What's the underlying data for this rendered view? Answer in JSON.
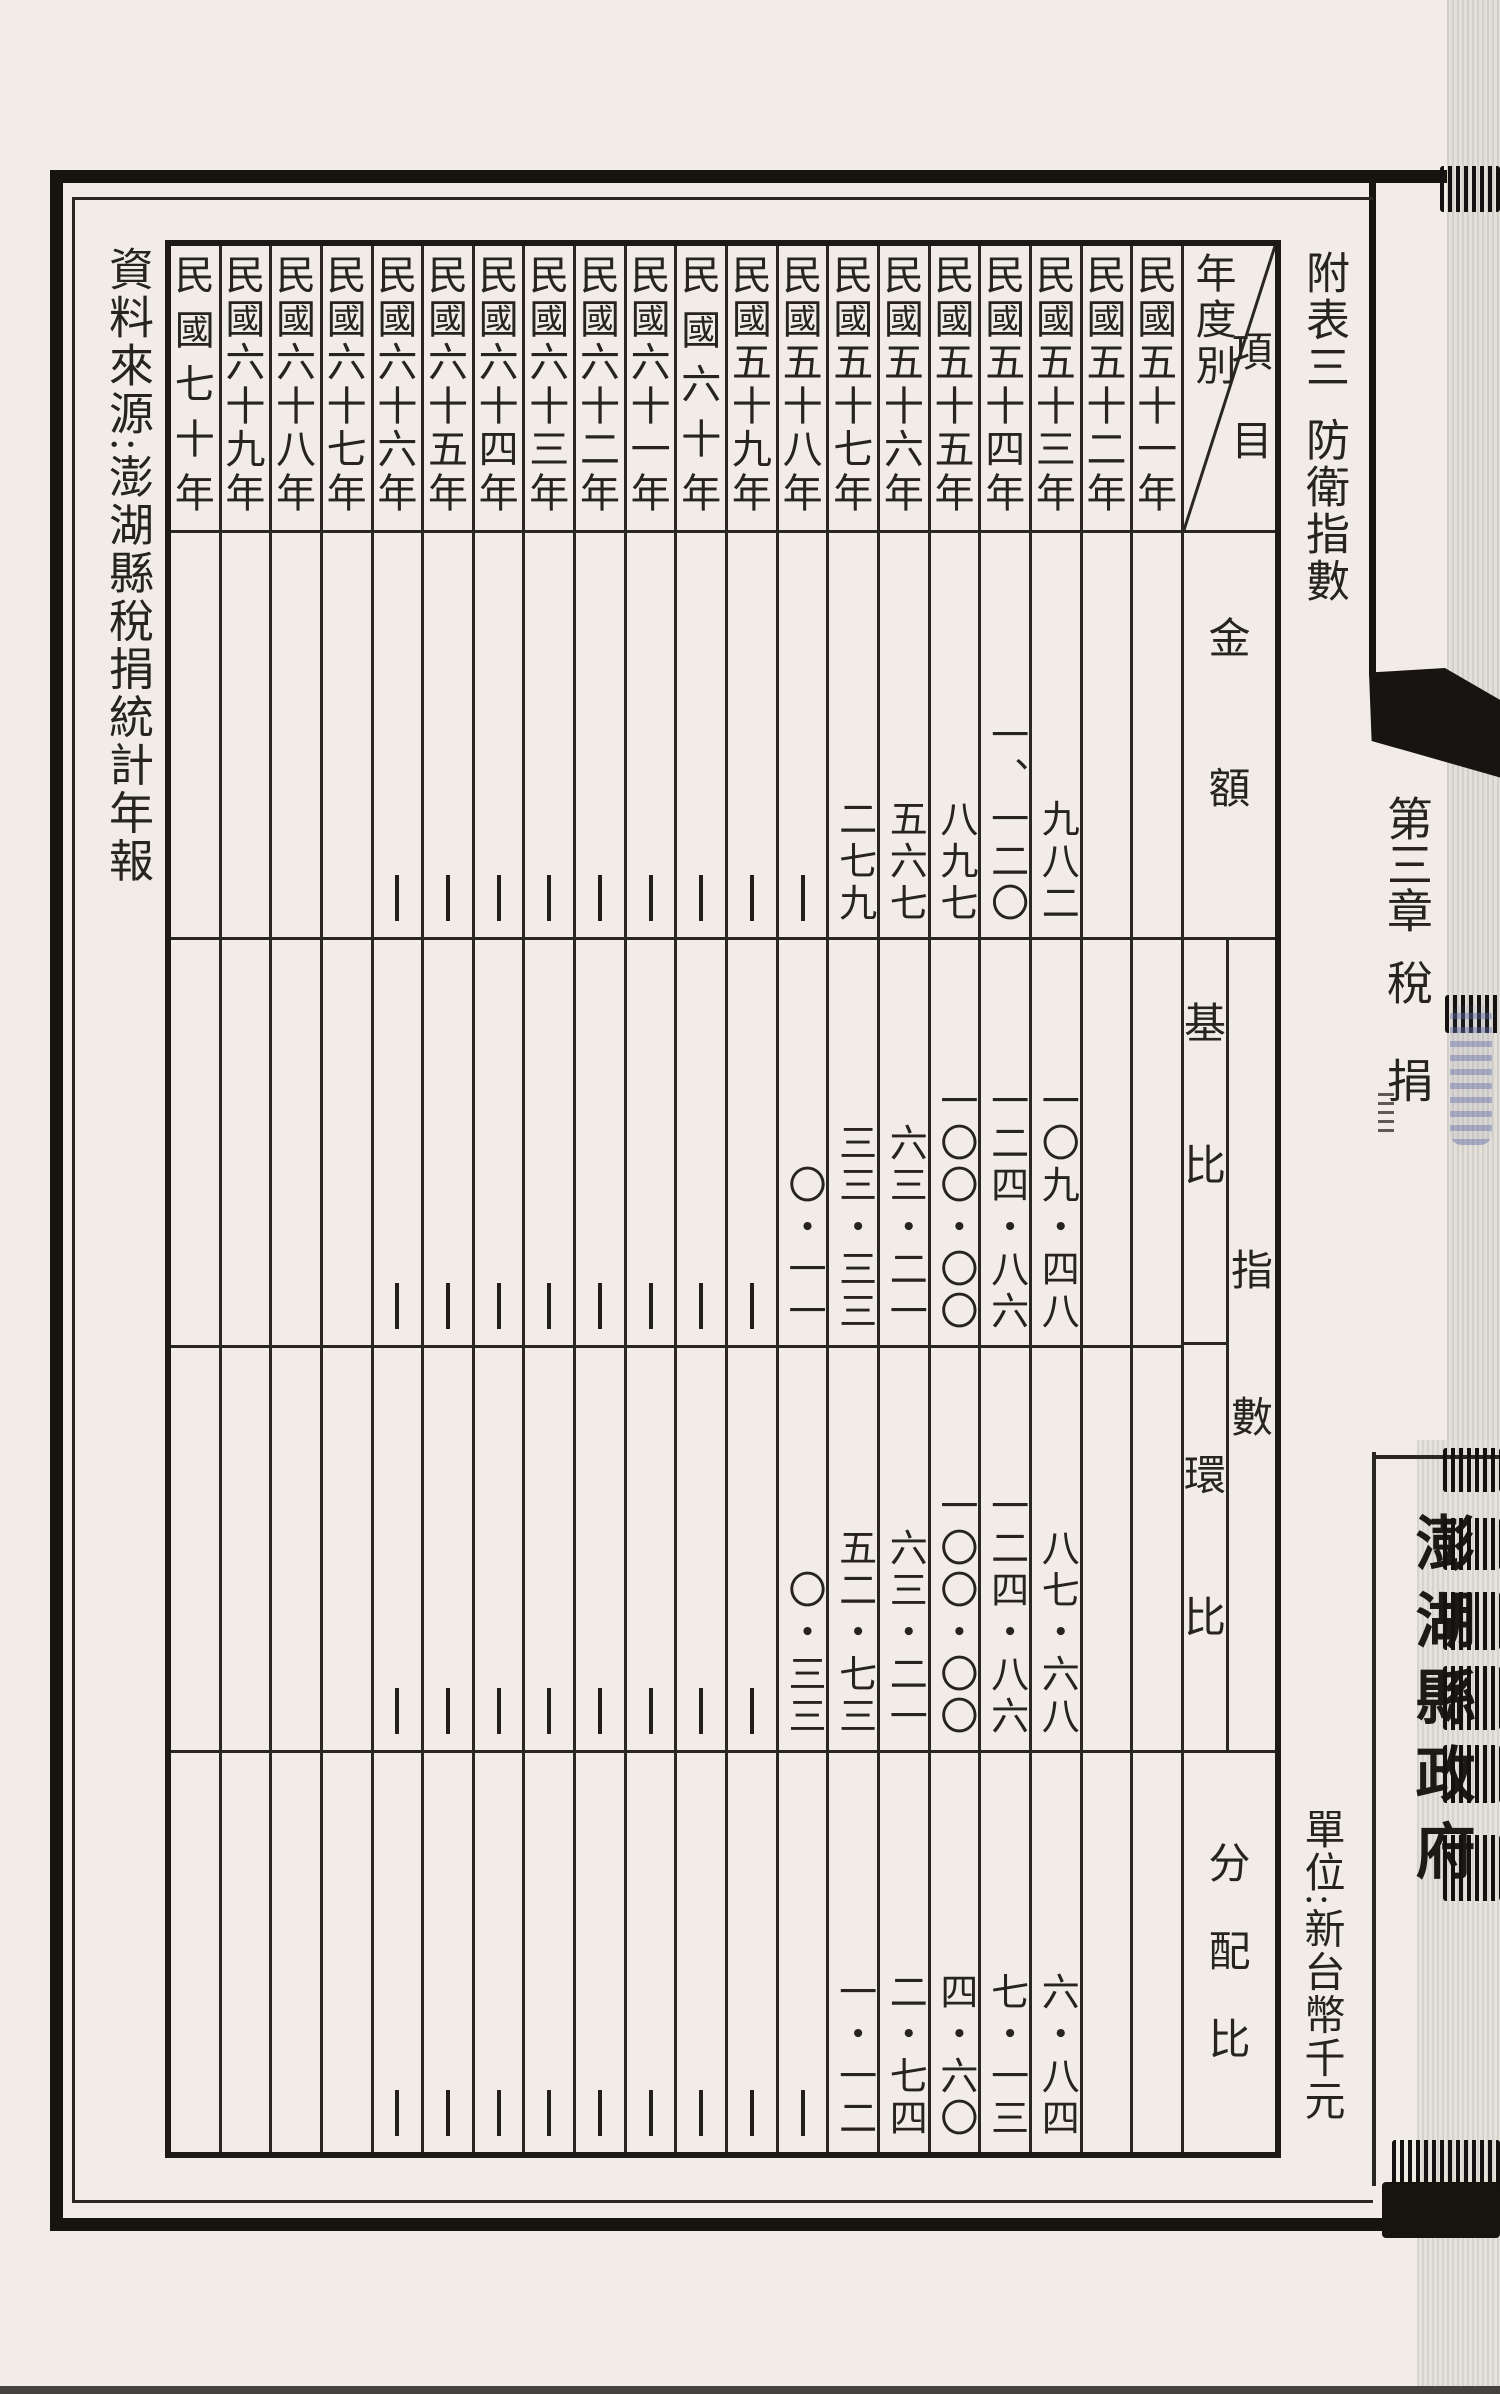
{
  "page": {
    "source_note": "資料來源:澎湖縣稅捐統計年報",
    "table_no": "附表三",
    "table_title": "防衛指數",
    "chapter": "第三章",
    "chapter_topic": "稅捐",
    "book_title": "澎湖縣政府",
    "unit_note": "單位:新台幣千元"
  },
  "table": {
    "corner": {
      "rows_label": "年度別",
      "cols_label": "項目"
    },
    "headers": {
      "amount": "金額",
      "index": "指數",
      "base": "基比",
      "chain": "環比",
      "dist": "分配比"
    },
    "years": [
      {
        "label": "民國五十一年",
        "amount": "",
        "base": "",
        "chain": "",
        "dist": ""
      },
      {
        "label": "民國五十二年",
        "amount": "",
        "base": "",
        "chain": "",
        "dist": ""
      },
      {
        "label": "民國五十三年",
        "amount": "九八二",
        "base": "一〇九・四八",
        "chain": "八七・六八",
        "dist": "六・八四"
      },
      {
        "label": "民國五十四年",
        "amount": "一、一二〇",
        "base": "一二四・八六",
        "chain": "一二四・八六",
        "dist": "七・一三"
      },
      {
        "label": "民國五十五年",
        "amount": "八九七",
        "base": "一〇〇・〇〇",
        "chain": "一〇〇・〇〇",
        "dist": "四・六〇"
      },
      {
        "label": "民國五十六年",
        "amount": "五六七",
        "base": "六三・二一",
        "chain": "六三・二一",
        "dist": "二・七四"
      },
      {
        "label": "民國五十七年",
        "amount": "二七九",
        "base": "三三・三三",
        "chain": "五二・七三",
        "dist": "一・一二"
      },
      {
        "label": "民國五十八年",
        "amount": "—",
        "base": "〇・一一",
        "chain": "〇・三三",
        "dist": "—"
      },
      {
        "label": "民國五十九年",
        "amount": "—",
        "base": "—",
        "chain": "—",
        "dist": "—"
      },
      {
        "label": "民國六十年",
        "amount": "—",
        "base": "—",
        "chain": "—",
        "dist": "—"
      },
      {
        "label": "民國六十一年",
        "amount": "—",
        "base": "—",
        "chain": "—",
        "dist": "—"
      },
      {
        "label": "民國六十二年",
        "amount": "—",
        "base": "—",
        "chain": "—",
        "dist": "—"
      },
      {
        "label": "民國六十三年",
        "amount": "—",
        "base": "—",
        "chain": "—",
        "dist": "—"
      },
      {
        "label": "民國六十四年",
        "amount": "—",
        "base": "—",
        "chain": "—",
        "dist": "—"
      },
      {
        "label": "民國六十五年",
        "amount": "—",
        "base": "—",
        "chain": "—",
        "dist": "—"
      },
      {
        "label": "民國六十六年",
        "amount": "—",
        "base": "—",
        "chain": "—",
        "dist": "—"
      },
      {
        "label": "民國六十七年",
        "amount": "",
        "base": "",
        "chain": "",
        "dist": ""
      },
      {
        "label": "民國六十八年",
        "amount": "",
        "base": "",
        "chain": "",
        "dist": ""
      },
      {
        "label": "民國六十九年",
        "amount": "",
        "base": "",
        "chain": "",
        "dist": ""
      },
      {
        "label": "民國七十年",
        "amount": "",
        "base": "",
        "chain": "",
        "dist": ""
      }
    ]
  },
  "colors": {
    "paper": "#f1ede6",
    "ink": "#262320",
    "line": "#2a2622",
    "frame": "#17140f"
  }
}
